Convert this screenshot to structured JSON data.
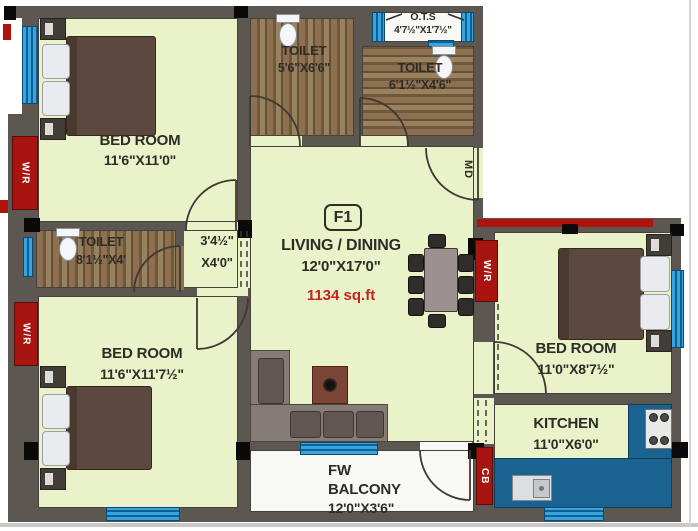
{
  "plan": {
    "unit_label": "F1",
    "area_label": "1134 sq.ft",
    "rooms": {
      "bedroom_top_left": {
        "name": "BED ROOM",
        "dims": "11'6\"X11'0\""
      },
      "toilet_top": {
        "name": "TOILET",
        "dims": "5'6\"X6'6\""
      },
      "ots": {
        "name": "O.T.S",
        "dims": "4'7½\"X1'7½\""
      },
      "toilet_right": {
        "name": "TOILET",
        "dims": "6'1½\"X4'6\""
      },
      "toilet_left": {
        "name": "TOILET",
        "dims": "8'1½\"X4'"
      },
      "passage": {
        "dims_line1": "3'4½\"",
        "dims_line2": "X4'0\""
      },
      "living": {
        "name": "LIVING / DINING",
        "dims": "12'0\"X17'0\""
      },
      "bedroom_bottom_left": {
        "name": "BED ROOM",
        "dims": "11'6\"X11'7½\""
      },
      "bedroom_right": {
        "name": "BED ROOM",
        "dims": "11'0\"X8'7½\""
      },
      "kitchen": {
        "name": "KITCHEN",
        "dims": "11'0\"X6'0\""
      },
      "balcony": {
        "line1": "FW",
        "line2": "BALCONY",
        "line3": "12'0\"X3'6\""
      }
    },
    "markers": {
      "wardrobe": "W/R",
      "main_door": "MD",
      "cupboard": "CB"
    },
    "colors": {
      "wall": "#5d5751",
      "floor_green": "#eaf2c9",
      "wardrobe_red": "#a81410",
      "window_blue": "#37a5e0",
      "kitchen_counter": "#1a628f",
      "area_text_red": "#c42420",
      "label_text": "#2e2c27"
    }
  }
}
